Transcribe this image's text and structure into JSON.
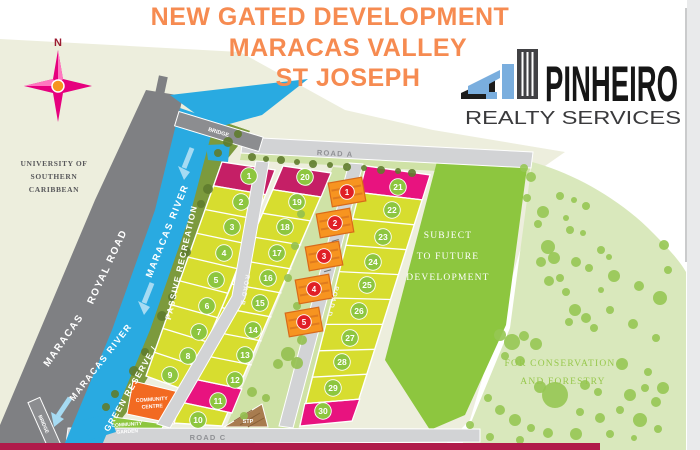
{
  "header": {
    "title_line1": "NEW GATED DEVELOPMENT",
    "title_line2": "MARACAS VALLEY",
    "title_line3": "ST JOSEPH"
  },
  "logo": {
    "name": "PINHEIRO",
    "tagline": "REALTY SERVICES"
  },
  "map": {
    "compass_label": "N",
    "university": {
      "line1": "UNIVERSITY OF",
      "line2": "SOUTHERN",
      "line3": "CARIBBEAN"
    },
    "roads": {
      "royal_road": "ROYAL ROAD",
      "maracas": "MARACAS",
      "road_a": "ROAD A",
      "road_b": "ROAD B",
      "road_c": "ROAD C",
      "road_d": "ROAD D",
      "bridge_top": "BRIDGE",
      "bridge_bottom": "BRIDGE"
    },
    "river": {
      "label_upper": "MARACAS RIVER",
      "label_lower": "MARACAS RIVER"
    },
    "green": {
      "passive": "PASSIVE RECREATION",
      "reserve": "GREEN RESERVE /",
      "future_line1": "SUBJECT",
      "future_line2": "TO FUTURE",
      "future_line3": "DEVELOPMENT",
      "conservation_line1": "FOR CONSERVATION",
      "conservation_line2": "AND FORESTRY"
    },
    "facilities": {
      "centre_line1": "COMMUNITY",
      "centre_line2": "CENTRE",
      "garden_line1": "COMMUNITY",
      "garden_line2": "GARDEN",
      "stp": "STP"
    },
    "lots": [
      {
        "n": "1",
        "x": 249,
        "y": 176
      },
      {
        "n": "2",
        "x": 241,
        "y": 202
      },
      {
        "n": "3",
        "x": 232,
        "y": 227
      },
      {
        "n": "4",
        "x": 224,
        "y": 253
      },
      {
        "n": "5",
        "x": 216,
        "y": 280
      },
      {
        "n": "6",
        "x": 207,
        "y": 306
      },
      {
        "n": "7",
        "x": 199,
        "y": 332
      },
      {
        "n": "8",
        "x": 188,
        "y": 356
      },
      {
        "n": "9",
        "x": 170,
        "y": 375
      },
      {
        "n": "10",
        "x": 198,
        "y": 420
      },
      {
        "n": "11",
        "x": 218,
        "y": 401
      },
      {
        "n": "12",
        "x": 235,
        "y": 380
      },
      {
        "n": "13",
        "x": 245,
        "y": 355
      },
      {
        "n": "14",
        "x": 253,
        "y": 330
      },
      {
        "n": "15",
        "x": 260,
        "y": 303
      },
      {
        "n": "16",
        "x": 268,
        "y": 278
      },
      {
        "n": "17",
        "x": 277,
        "y": 253
      },
      {
        "n": "18",
        "x": 285,
        "y": 227
      },
      {
        "n": "19",
        "x": 297,
        "y": 202
      },
      {
        "n": "20",
        "x": 305,
        "y": 177
      },
      {
        "n": "21",
        "x": 398,
        "y": 187
      },
      {
        "n": "22",
        "x": 392,
        "y": 210
      },
      {
        "n": "23",
        "x": 383,
        "y": 237
      },
      {
        "n": "24",
        "x": 373,
        "y": 262
      },
      {
        "n": "25",
        "x": 367,
        "y": 285
      },
      {
        "n": "26",
        "x": 359,
        "y": 311
      },
      {
        "n": "27",
        "x": 350,
        "y": 338
      },
      {
        "n": "28",
        "x": 342,
        "y": 362
      },
      {
        "n": "29",
        "x": 333,
        "y": 388
      },
      {
        "n": "30",
        "x": 323,
        "y": 411
      }
    ],
    "units": [
      {
        "n": "1",
        "x": 347,
        "y": 192
      },
      {
        "n": "2",
        "x": 335,
        "y": 223
      },
      {
        "n": "3",
        "x": 324,
        "y": 256
      },
      {
        "n": "4",
        "x": 314,
        "y": 289
      },
      {
        "n": "5",
        "x": 304,
        "y": 322
      }
    ],
    "trees_olive": [
      [
        228,
        142,
        5
      ],
      [
        238,
        134,
        4
      ],
      [
        218,
        153,
        4
      ],
      [
        208,
        189,
        5
      ],
      [
        201,
        204,
        4
      ],
      [
        186,
        252,
        5
      ],
      [
        172,
        297,
        4
      ],
      [
        162,
        316,
        5
      ],
      [
        145,
        352,
        4
      ],
      [
        134,
        371,
        5
      ],
      [
        115,
        394,
        4
      ],
      [
        106,
        407,
        4
      ],
      [
        252,
        157,
        4
      ],
      [
        266,
        159,
        3
      ],
      [
        281,
        160,
        4
      ],
      [
        297,
        162,
        3
      ],
      [
        313,
        164,
        4
      ],
      [
        330,
        165,
        3
      ],
      [
        347,
        167,
        4
      ],
      [
        364,
        168,
        3
      ],
      [
        381,
        170,
        4
      ],
      [
        398,
        171,
        3
      ],
      [
        412,
        173,
        4
      ]
    ],
    "trees_mid": [
      [
        307,
        182,
        4
      ],
      [
        301,
        214,
        4
      ],
      [
        295,
        246,
        4
      ],
      [
        288,
        278,
        4
      ],
      [
        297,
        306,
        4
      ],
      [
        302,
        340,
        5
      ],
      [
        288,
        354,
        7
      ],
      [
        297,
        363,
        6
      ],
      [
        278,
        364,
        5
      ],
      [
        252,
        392,
        5
      ],
      [
        266,
        398,
        4
      ],
      [
        244,
        416,
        4
      ]
    ],
    "trees_cons": [
      [
        524,
        168,
        4
      ],
      [
        531,
        177,
        5
      ],
      [
        527,
        198,
        4
      ],
      [
        543,
        212,
        6
      ],
      [
        538,
        224,
        4
      ],
      [
        560,
        196,
        4
      ],
      [
        574,
        200,
        3
      ],
      [
        586,
        206,
        4
      ],
      [
        566,
        218,
        3
      ],
      [
        548,
        247,
        7
      ],
      [
        554,
        258,
        6
      ],
      [
        541,
        262,
        5
      ],
      [
        570,
        230,
        4
      ],
      [
        583,
        233,
        3
      ],
      [
        601,
        250,
        4
      ],
      [
        609,
        257,
        3
      ],
      [
        576,
        262,
        5
      ],
      [
        589,
        268,
        4
      ],
      [
        560,
        278,
        4
      ],
      [
        549,
        281,
        5
      ],
      [
        566,
        292,
        4
      ],
      [
        601,
        290,
        3
      ],
      [
        575,
        310,
        6
      ],
      [
        586,
        318,
        5
      ],
      [
        569,
        322,
        4
      ],
      [
        594,
        328,
        4
      ],
      [
        614,
        276,
        6
      ],
      [
        639,
        286,
        5
      ],
      [
        660,
        298,
        7
      ],
      [
        633,
        324,
        5
      ],
      [
        656,
        338,
        4
      ],
      [
        622,
        364,
        6
      ],
      [
        648,
        372,
        4
      ],
      [
        663,
        388,
        6
      ],
      [
        610,
        310,
        4
      ],
      [
        500,
        335,
        6
      ],
      [
        512,
        342,
        8
      ],
      [
        524,
        336,
        5
      ],
      [
        536,
        344,
        6
      ],
      [
        505,
        356,
        4
      ],
      [
        520,
        361,
        5
      ],
      [
        555,
        395,
        13
      ],
      [
        540,
        387,
        6
      ],
      [
        585,
        385,
        5
      ],
      [
        598,
        392,
        4
      ],
      [
        630,
        395,
        6
      ],
      [
        645,
        388,
        4
      ],
      [
        656,
        402,
        5
      ],
      [
        620,
        410,
        4
      ],
      [
        600,
        418,
        5
      ],
      [
        580,
        412,
        4
      ],
      [
        640,
        420,
        7
      ],
      [
        658,
        429,
        4
      ],
      [
        500,
        410,
        5
      ],
      [
        488,
        398,
        4
      ],
      [
        515,
        420,
        6
      ],
      [
        531,
        428,
        4
      ],
      [
        470,
        425,
        4
      ],
      [
        548,
        433,
        5
      ],
      [
        576,
        434,
        6
      ],
      [
        610,
        434,
        4
      ],
      [
        634,
        438,
        3
      ],
      [
        520,
        440,
        4
      ],
      [
        490,
        437,
        4
      ],
      [
        668,
        270,
        4
      ],
      [
        664,
        245,
        5
      ]
    ],
    "colors": {
      "title_orange": "#f68b51",
      "lot_yellow": "#d7dd2f",
      "sold_magenta": "#c51f66",
      "sold_pink": "#e8137f",
      "lot_circle": "#8dc63f",
      "unit_circle": "#e01f26",
      "house": "#f79420",
      "house_stroke": "#d86a1a",
      "house_stripe": "#e07b1e",
      "river_blue": "#29aae1",
      "arrow_blue": "#a6dbf3",
      "road_dark": "#7f8083",
      "road_light": "#d2d3d5",
      "olive_strip": "#7c9a3d",
      "pale_strip": "#cfe2a6",
      "future_green": "#8dc63f",
      "conservation_green": "#d9e8bc",
      "tree_olive": "#5f7c2d",
      "tree_mid": "#94c050",
      "tree_cons": "#96c753",
      "beige": "#edeedd",
      "crimson_bar": "#b01b4a",
      "centre_orange": "#f26a21",
      "garden_green": "#8dc63f",
      "stp_brown": "#a87c4f"
    }
  }
}
